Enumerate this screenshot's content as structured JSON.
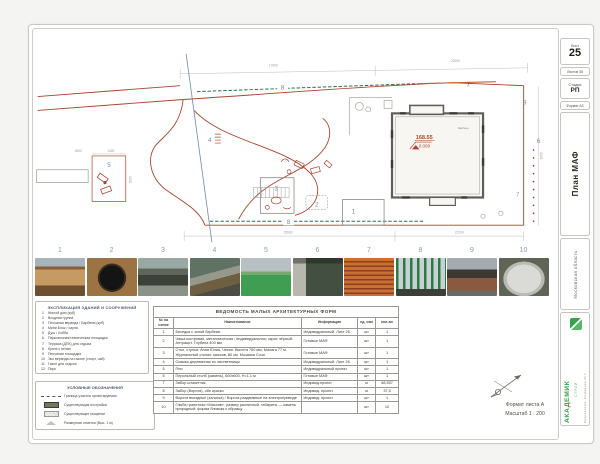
{
  "stamp": {
    "sheet_label": "Лист",
    "sheet_number": "25",
    "sheets_total": "Листов 36",
    "stage_label": "Стадия",
    "stage_value": "РП",
    "format": "Формат А3",
    "drawing_title": "План МАФ",
    "region": "Московская область",
    "company_name": "АКАДЕМИК",
    "company_sub": "СТРОЙ",
    "developed_by": "Разработал: Семенова Ю.Г."
  },
  "plan": {
    "dims": {
      "top_left": "17000",
      "top_right": "22000",
      "bottom_left": "15600",
      "bottom_right": "22200",
      "w4000": "4000",
      "w1400": "1400",
      "h2000": "2000",
      "h3000": "3000"
    },
    "elevation": {
      "abs": "168.55",
      "rel": "0.000"
    },
    "building_label": "Щебень",
    "markers": [
      "1",
      "2",
      "3",
      "4",
      "5",
      "6",
      "7",
      "8",
      "9"
    ]
  },
  "photos": {
    "numbers": [
      "1",
      "2",
      "3",
      "4",
      "5",
      "6",
      "7",
      "8",
      "9",
      "10"
    ]
  },
  "explication": {
    "title": "ЭКСПЛИКАЦИЯ ЗДАНИЙ И СООРУЖЕНИЙ",
    "items": [
      {
        "n": "1",
        "label": "Жилой дом (куб)"
      },
      {
        "n": "2",
        "label": "Входная группа"
      },
      {
        "n": "3",
        "label": "Песчаная веранда / Барбекю (куб)"
      },
      {
        "n": "4",
        "label": "Мини Блок / сауна"
      },
      {
        "n": "5",
        "label": "Душ / Хобби"
      },
      {
        "n": "6",
        "label": "Парковочная/техническая площадка"
      },
      {
        "n": "7",
        "label": "Терраса (ДПК) для отдыха"
      },
      {
        "n": "8",
        "label": "Кухня с печью"
      },
      {
        "n": "9",
        "label": "Песчаная площадка"
      },
      {
        "n": "10",
        "label": "Эко веранда на газоне (спорт, чай)"
      },
      {
        "n": "11",
        "label": "Газон для отдыха"
      },
      {
        "n": "12",
        "label": "Пирс"
      }
    ]
  },
  "legend": {
    "title": "УСЛОВНЫЕ ОБОЗНАЧЕНИЯ",
    "items": [
      {
        "label": "Граница участка проектируемая"
      },
      {
        "label": "Существующая постройка"
      },
      {
        "label": "Существующее мощение"
      },
      {
        "label": "Размерная отметка (Выс. 1 м)"
      }
    ]
  },
  "maf": {
    "title": "ВЕДОМОСТЬ МАЛЫХ АРХИТЕКТУРНЫХ ФОРМ",
    "columns": [
      "№ на схеме",
      "Наименование",
      "Информация",
      "ед. изм",
      "кол-во"
    ],
    "rows": [
      [
        "1",
        "Беседка с зоной барбекю",
        "Индивидуальный. Лист 26",
        "шт",
        "1"
      ],
      [
        "2",
        "Чаша костровая, металлическая / индивидуальная; окрас чёрный. Антрацит. Глубина 400 мм",
        "Готовые МАФ",
        "шт",
        "1"
      ],
      [
        "3",
        "Стол, стулья: Анна Юлия, Чехия. Высота 760 мм, Малага 77 м. Журнальный столик: массив, 80 см. Мозаика Сочи",
        "Готовые МАФ",
        "шт",
        "1"
      ],
      [
        "4",
        "Скамья деревянная из лиственницы",
        "Индивидуальный. Лист 26",
        "шт",
        "1"
      ],
      [
        "5",
        "Пни",
        "Индивидуальный проект",
        "шт",
        "1"
      ],
      [
        "6",
        "Перильный столб (камень), 600х600, Н=1,1 м",
        "Готовые МАФ",
        "шт",
        "1"
      ],
      [
        "7",
        "Забор штакетник",
        "Индивид.проект",
        "м",
        "68,557"
      ],
      [
        "8",
        "Забор (Ворота), обе краски",
        "Индивид. проект",
        "м",
        "37,5"
      ],
      [
        "9",
        "Ворота въездные (калитка) / Ворота раздвижные на электроприводе",
        "Индивид. проект",
        "шт",
        "1"
      ],
      [
        "10",
        "Глыба гранитная «Массив», размер различный, габариты — камень природный; форма близкая к образцу",
        "",
        "шт",
        "10"
      ]
    ]
  },
  "footer": {
    "format": "Формат листа А",
    "scale": "Масштаб 1 : 200"
  }
}
